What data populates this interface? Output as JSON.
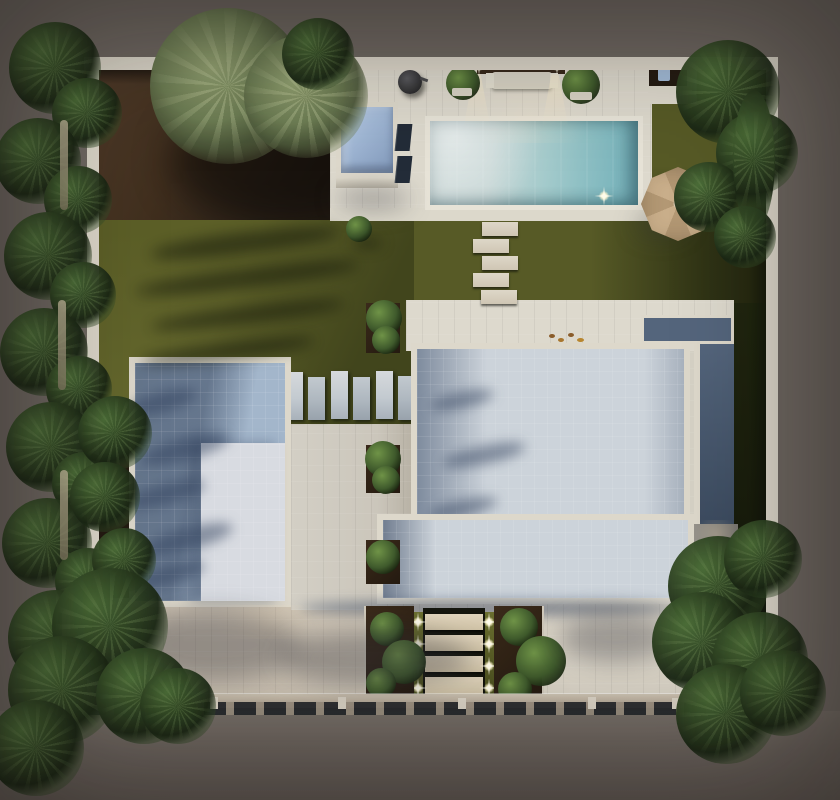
{
  "scene": {
    "setting": "Dusk aerial 3D render of a modern villa plot with pool, lawns, palm trees and lit entrance steps",
    "objects": [
      "perimeter wall",
      "swimming pool",
      "spa structure",
      "outdoor lounge with wall lights",
      "barbecue grill",
      "sun loungers",
      "parasol",
      "stepping stones",
      "paver path",
      "main villa roof",
      "garage roof",
      "lawn",
      "soil beds",
      "palm trees",
      "pine trees",
      "entrance steps with lights",
      "planters",
      "driveway",
      "sidewalk",
      "curb",
      "road",
      "concrete pad"
    ],
    "counts": {
      "entrance_steps": 4,
      "entrance_lights": 8,
      "stepping_stones": 5,
      "pavers": 8,
      "kitchen_lights": 2,
      "pool_underwater_lights": 1
    }
  },
  "palette": {
    "bg": "#6f6862",
    "road": "#6b635d",
    "wall": "#ddd8cb",
    "terrace": "#d6d2c6",
    "terraceBright": "#ddd9cd",
    "soil": "#43311f",
    "soilDark": "#271e15",
    "lawn": "#575a26",
    "lawnLight": "#646728",
    "lawnShadow": "#2c3314",
    "lawnDark": "#1c220d",
    "waterLight": "#ccd8d7",
    "waterMid": "#a5cbcc",
    "waterTeal": "#7db6bd",
    "structureBlue": "#a9c0dd",
    "structureBlueDark": "#7e97b8",
    "roofTile": "#ccd3da",
    "roofDark": "#54657c",
    "roofDarker": "#3c4b5f",
    "garageRoof": "#a3b6cb",
    "garageRoofLight": "#d8dbe1",
    "parasol": "#c9ae8a",
    "parasolDark": "#b39874",
    "planter": "#2f2115",
    "shrub": "#3f5a2c",
    "shrubLight": "#6f9347",
    "treeDark": "#24351c",
    "treeLight": "#4c6e38",
    "palm": "#6c7c53",
    "palmLight": "#93a272",
    "driveway": "#c7bcac",
    "drivewayLight": "#d9d3c6",
    "sidewalk": "#b3a795",
    "curb": "#23262a",
    "glow": "#ffeec6",
    "cushion": "#d9d4c6",
    "wood": "#37291b",
    "bbq": "#2e2e30",
    "lounger": "#232c38",
    "pad": "#8b8781"
  }
}
